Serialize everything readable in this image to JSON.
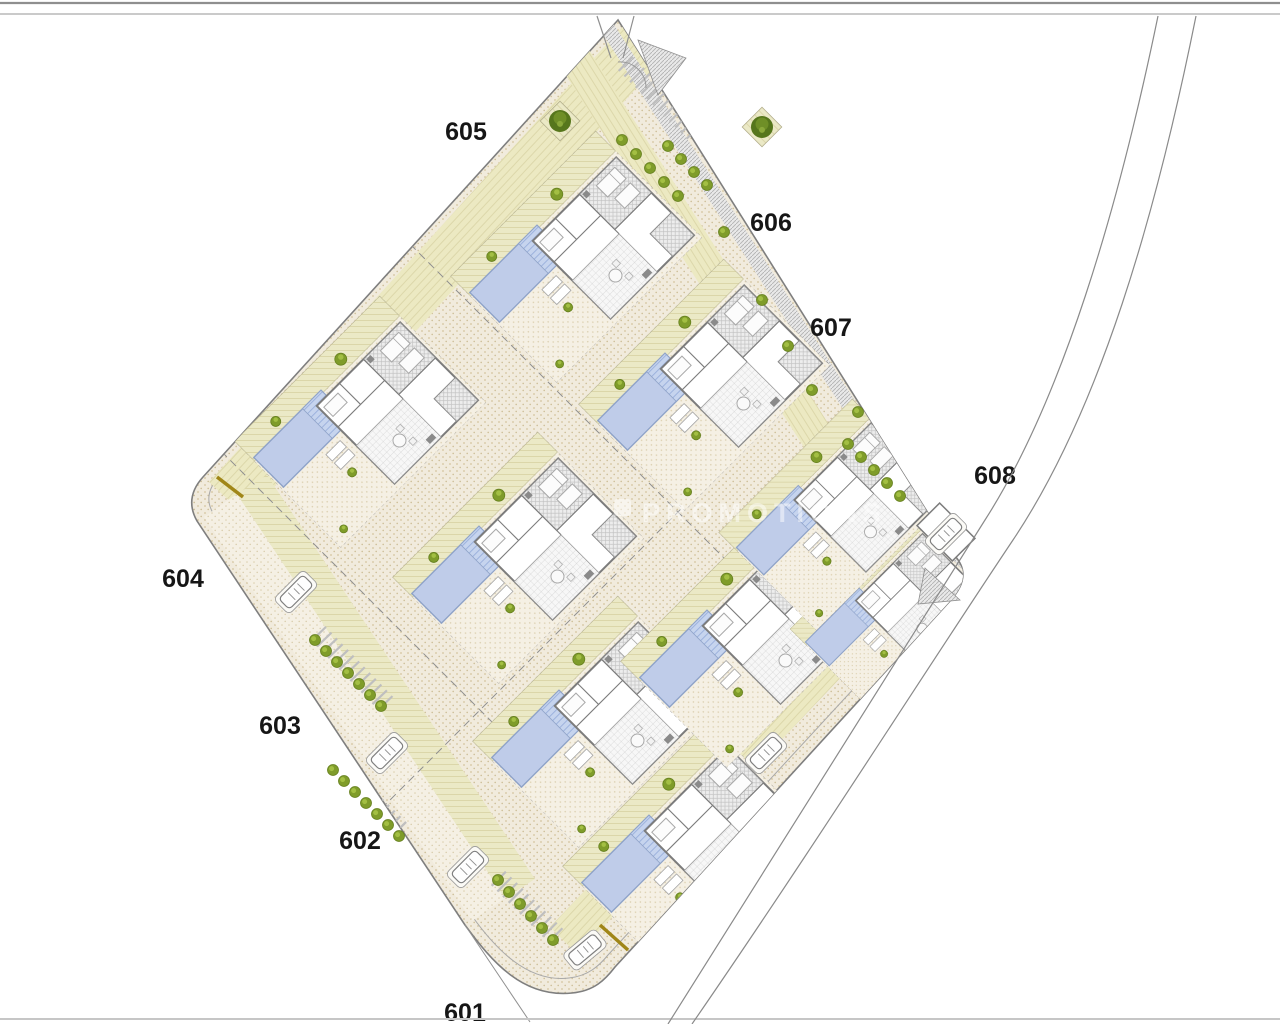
{
  "meta": {
    "title": "Residential development site plan",
    "type": "architectural-site-plan",
    "description": "Top-view urbanization plan of detached villas with private pools on a diamond-shaped parcel bounded by a curved road"
  },
  "colors": {
    "background": "#ffffff",
    "outline": "#7f7f7f",
    "outline_inner": "#a8a8a8",
    "wall": "#7c7c7c",
    "lawn": "#ebe9c6",
    "lawn_line": "#d7d2a2",
    "sand": "#f1ebdd",
    "sand_dot": "#d2c19a",
    "pool_fill": "#c0cdea",
    "pool_line": "#9bb0da",
    "roof_hatch": "#c2c2c2",
    "bush": "#7f9c2a",
    "bush_light": "#a3bf43",
    "tree": "#56761c",
    "marker_brown": "#a08618",
    "label_text": "#161616",
    "border_top": "#8f8f8f",
    "border_bottom": "#c6c6c6"
  },
  "watermark": {
    "text": "PROMOTIONS",
    "opacity": 0.5
  },
  "plot_labels": [
    {
      "text": "601",
      "x": 465,
      "y": 1021
    },
    {
      "text": "602",
      "x": 360,
      "y": 849
    },
    {
      "text": "603",
      "x": 280,
      "y": 734
    },
    {
      "text": "604",
      "x": 183,
      "y": 587
    },
    {
      "text": "605",
      "x": 466,
      "y": 140
    },
    {
      "text": "606",
      "x": 771,
      "y": 231
    },
    {
      "text": "607",
      "x": 831,
      "y": 336
    },
    {
      "text": "608",
      "x": 995,
      "y": 484
    }
  ],
  "villas": [
    {
      "cx": 690,
      "cy": 845,
      "scale": 1
    },
    {
      "cx": 600,
      "cy": 720,
      "scale": 1
    },
    {
      "cx": 748,
      "cy": 640,
      "scale": 1
    },
    {
      "cx": 892,
      "cy": 612,
      "scale": 0.8
    },
    {
      "cx": 520,
      "cy": 556,
      "scale": 1
    },
    {
      "cx": 362,
      "cy": 420,
      "scale": 1
    },
    {
      "cx": 836,
      "cy": 513,
      "scale": 0.92
    },
    {
      "cx": 706,
      "cy": 383,
      "scale": 1
    },
    {
      "cx": 578,
      "cy": 255,
      "scale": 1
    }
  ],
  "cars": [
    {
      "x": 296,
      "y": 592,
      "rot": 45
    },
    {
      "x": 387,
      "y": 753,
      "rot": 45
    },
    {
      "x": 468,
      "y": 867,
      "rot": 45
    },
    {
      "x": 585,
      "y": 950,
      "rot": 50
    },
    {
      "x": 946,
      "y": 534,
      "rot": 45
    },
    {
      "x": 766,
      "y": 753,
      "rot": 45
    }
  ],
  "bush_rows": [
    {
      "x": 315,
      "y": 640,
      "dx": 11,
      "dy": 11,
      "count": 7
    },
    {
      "x": 333,
      "y": 770,
      "dx": 11,
      "dy": 11,
      "count": 7
    },
    {
      "x": 498,
      "y": 880,
      "dx": 11,
      "dy": 12,
      "count": 6
    },
    {
      "x": 622,
      "y": 140,
      "dx": 14,
      "dy": 14,
      "count": 5
    },
    {
      "x": 668,
      "y": 146,
      "dx": 13,
      "dy": 13,
      "count": 4
    },
    {
      "x": 848,
      "y": 444,
      "dx": 13,
      "dy": 13,
      "count": 5
    }
  ],
  "bushes": [
    {
      "x": 762,
      "y": 300
    },
    {
      "x": 788,
      "y": 346
    },
    {
      "x": 812,
      "y": 390
    },
    {
      "x": 724,
      "y": 232
    },
    {
      "x": 858,
      "y": 412
    }
  ],
  "trees": [
    {
      "x": 560,
      "y": 121
    },
    {
      "x": 762,
      "y": 127
    }
  ]
}
